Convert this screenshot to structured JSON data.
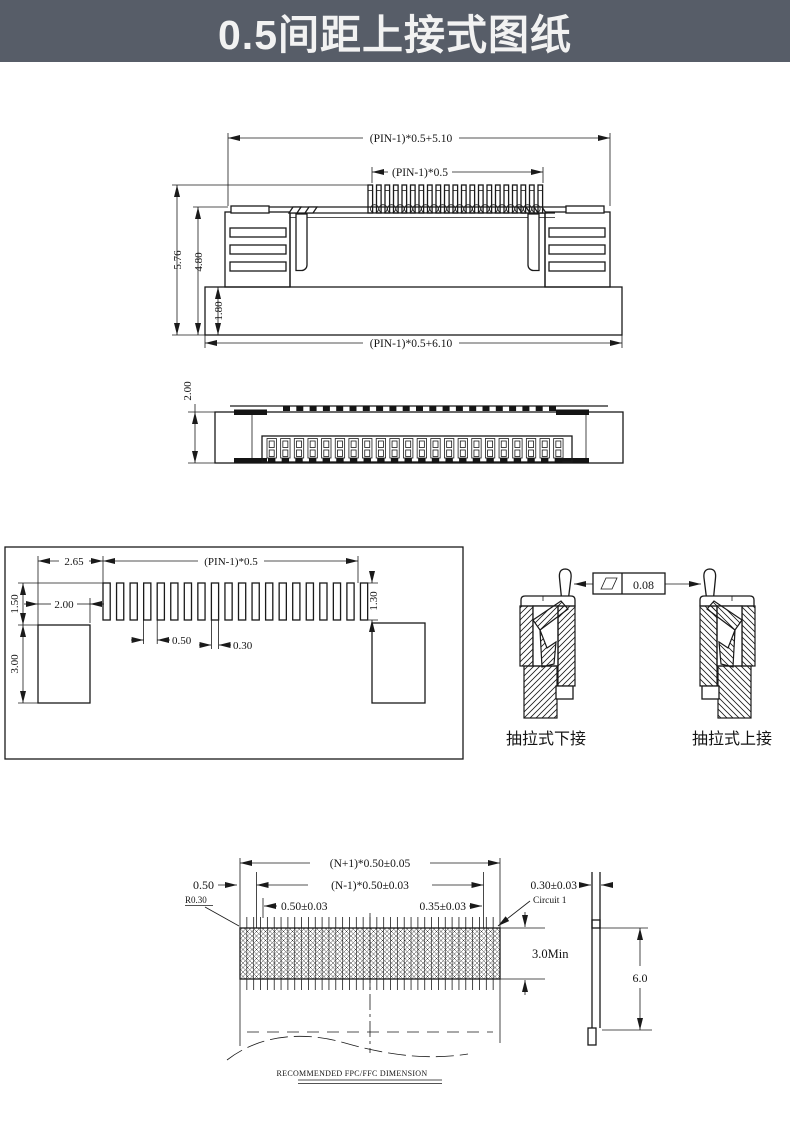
{
  "header": {
    "title": "0.5间距上接式图纸",
    "bg_color": "#575d68",
    "text_color": "#f2f2f2"
  },
  "colors": {
    "line": "#1a1a1a",
    "paper": "#ffffff"
  },
  "front_view": {
    "dim_overall_top": "(PIN-1)*0.5+5.10",
    "dim_pin_pitch": "(PIN-1)*0.5",
    "dim_height_total": "5.76",
    "dim_height_body": "4.80",
    "dim_height_base": "1.80",
    "dim_overall_bottom": "(PIN-1)*0.5+6.10"
  },
  "top_view": {
    "dim_depth": "2.00"
  },
  "footprint_view": {
    "dim_edge_offset": "2.65",
    "dim_pin_pitch": "(PIN-1)*0.5",
    "dim_pad_offset": "1.50",
    "dim_anchor_width": "2.00",
    "dim_anchor_height": "3.00",
    "dim_pad_pitch": "0.50",
    "dim_pad_width": "0.30",
    "dim_pad_length": "1.30"
  },
  "section_views": {
    "tolerance_value": "0.08",
    "label_lower_contact": "抽拉式下接",
    "label_upper_contact": "抽拉式上接"
  },
  "fpc_view": {
    "dim_total_width": "(N+1)*0.50±0.05",
    "dim_conductor_span": "(N-1)*0.50±0.03",
    "dim_end_margin": "0.50",
    "dim_corner_radius": "R0.30",
    "dim_conductor_pitch": "0.50±0.03",
    "dim_conductor_width": "0.35±0.03",
    "dim_thickness": "0.30±0.03",
    "label_circuit": "Circuit 1",
    "dim_exposed_length": "3.0Min",
    "dim_total_length": "6.0",
    "caption": "RECOMMENDED FPC/FFC DIMENSION"
  }
}
